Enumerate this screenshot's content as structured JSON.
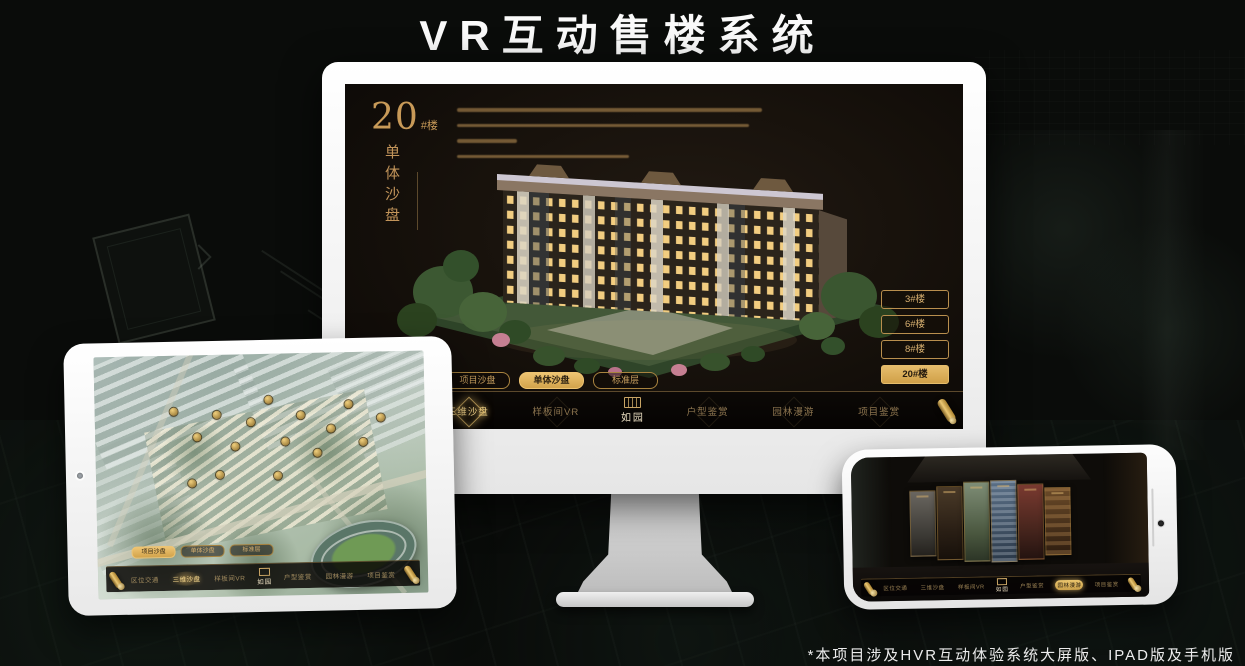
{
  "page": {
    "title": "VR互动售楼系统",
    "footnote": "*本项目涉及HVR互动体验系统大屏版、IPAD版及手机版"
  },
  "colors": {
    "gold": "#c9a565",
    "gold_active": "#deb264",
    "screen_bg": "#16110d"
  },
  "monitor": {
    "headline": {
      "number": "20",
      "suffix": "#楼",
      "subtitle": "单体沙盘"
    },
    "floor_buttons": [
      {
        "label": "3#楼",
        "active": false
      },
      {
        "label": "6#楼",
        "active": false
      },
      {
        "label": "8#楼",
        "active": false
      },
      {
        "label": "20#楼",
        "active": true
      }
    ],
    "view_tabs": [
      {
        "label": "项目沙盘",
        "active": false
      },
      {
        "label": "单体沙盘",
        "active": true
      },
      {
        "label": "标准层",
        "active": false
      }
    ],
    "nav": {
      "logo": "如园",
      "items": [
        {
          "label": "区位交通",
          "active": false
        },
        {
          "label": "三维沙盘",
          "active": true
        },
        {
          "label": "样板间VR",
          "active": false
        },
        {
          "label": "户型鉴赏",
          "active": false
        },
        {
          "label": "园林漫游",
          "active": false
        },
        {
          "label": "项目鉴赏",
          "active": false
        }
      ]
    }
  },
  "ipad": {
    "view_tabs": [
      {
        "label": "项目沙盘",
        "active": true
      },
      {
        "label": "单体沙盘",
        "active": false
      },
      {
        "label": "标准层",
        "active": false
      }
    ],
    "nav": {
      "logo": "如园",
      "items": [
        {
          "label": "区位交通",
          "active": false
        },
        {
          "label": "三维沙盘",
          "active": true
        },
        {
          "label": "样板间VR",
          "active": false
        },
        {
          "label": "户型鉴赏",
          "active": false
        },
        {
          "label": "园林漫游",
          "active": false
        },
        {
          "label": "项目鉴赏",
          "active": false
        }
      ]
    }
  },
  "phone": {
    "nav": {
      "logo": "如园",
      "items": [
        {
          "label": "区位交通",
          "active": false
        },
        {
          "label": "三维沙盘",
          "active": false
        },
        {
          "label": "样板间VR",
          "active": false
        },
        {
          "label": "户型鉴赏",
          "active": false
        },
        {
          "label": "园林漫游",
          "active": true
        },
        {
          "label": "项目鉴赏",
          "active": false
        }
      ]
    }
  }
}
